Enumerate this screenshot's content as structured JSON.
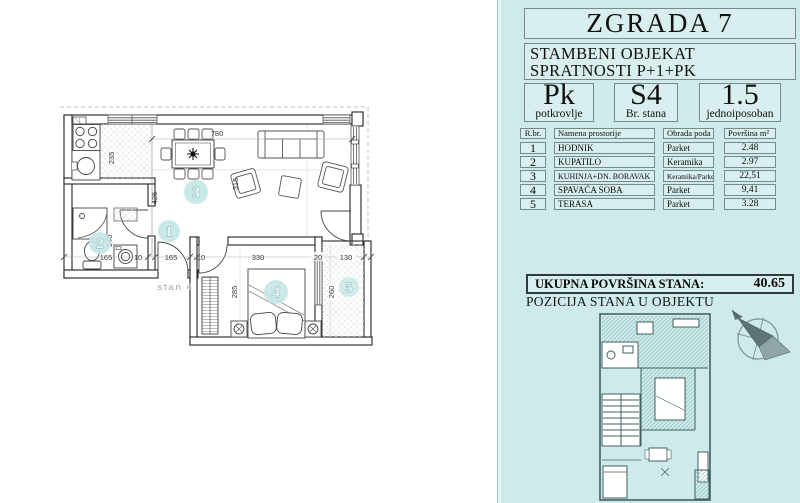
{
  "panel": {
    "title": "ZGRADA 7",
    "subtitle": [
      "STAMBENI OBJEKAT",
      "SPRATNOSTI P+1+PK"
    ],
    "info_boxes": [
      {
        "value": "Pk",
        "label": "potkrovlje"
      },
      {
        "value": "S4",
        "label": "Br. stana"
      },
      {
        "value": "1.5",
        "label": "jednoiposoban"
      }
    ],
    "table": {
      "headers": {
        "num": "R.br.",
        "name": "Namena prostorije",
        "floor": "Obrada poda",
        "area": "Površina  m²"
      },
      "rows": [
        {
          "num": "1",
          "name": "HODNIK",
          "floor": "Parket",
          "area": "2.48"
        },
        {
          "num": "2",
          "name": "KUPATILO",
          "floor": "Keramika",
          "area": "2.97"
        },
        {
          "num": "3",
          "name": "KUHINJA+DN. BORAVAK",
          "floor": "Keramika/Parket",
          "area": "22,51"
        },
        {
          "num": "4",
          "name": "SPAVAĆA SOBA",
          "floor": "Parket",
          "area": "9,41"
        },
        {
          "num": "5",
          "name": "TERASA",
          "floor": "Parket",
          "area": "3.28"
        }
      ]
    },
    "total": {
      "label": "UKUPNA POVRŠINA STANA:",
      "value": "40.65"
    },
    "position_title": "POZICIJA STANA  U OBJEKTU"
  },
  "floor_plan": {
    "unit_label": "stan 4",
    "room_numbers": {
      "hodnik": "1",
      "kupatilo": "2",
      "kuhinja": "3",
      "spavaca": "4",
      "terasa": "5"
    },
    "dims": {
      "d235": "235",
      "d425": "425",
      "d780": "780",
      "d315": "315",
      "d165": "165",
      "d10": "10",
      "d140": "140",
      "d330": "330",
      "d20": "20",
      "d130": "130",
      "d285": "285",
      "d260": "260"
    }
  },
  "colors": {
    "panel_bg": "#cfeaea",
    "accent_teal": "#7fb3b6",
    "wall": "#222222"
  }
}
